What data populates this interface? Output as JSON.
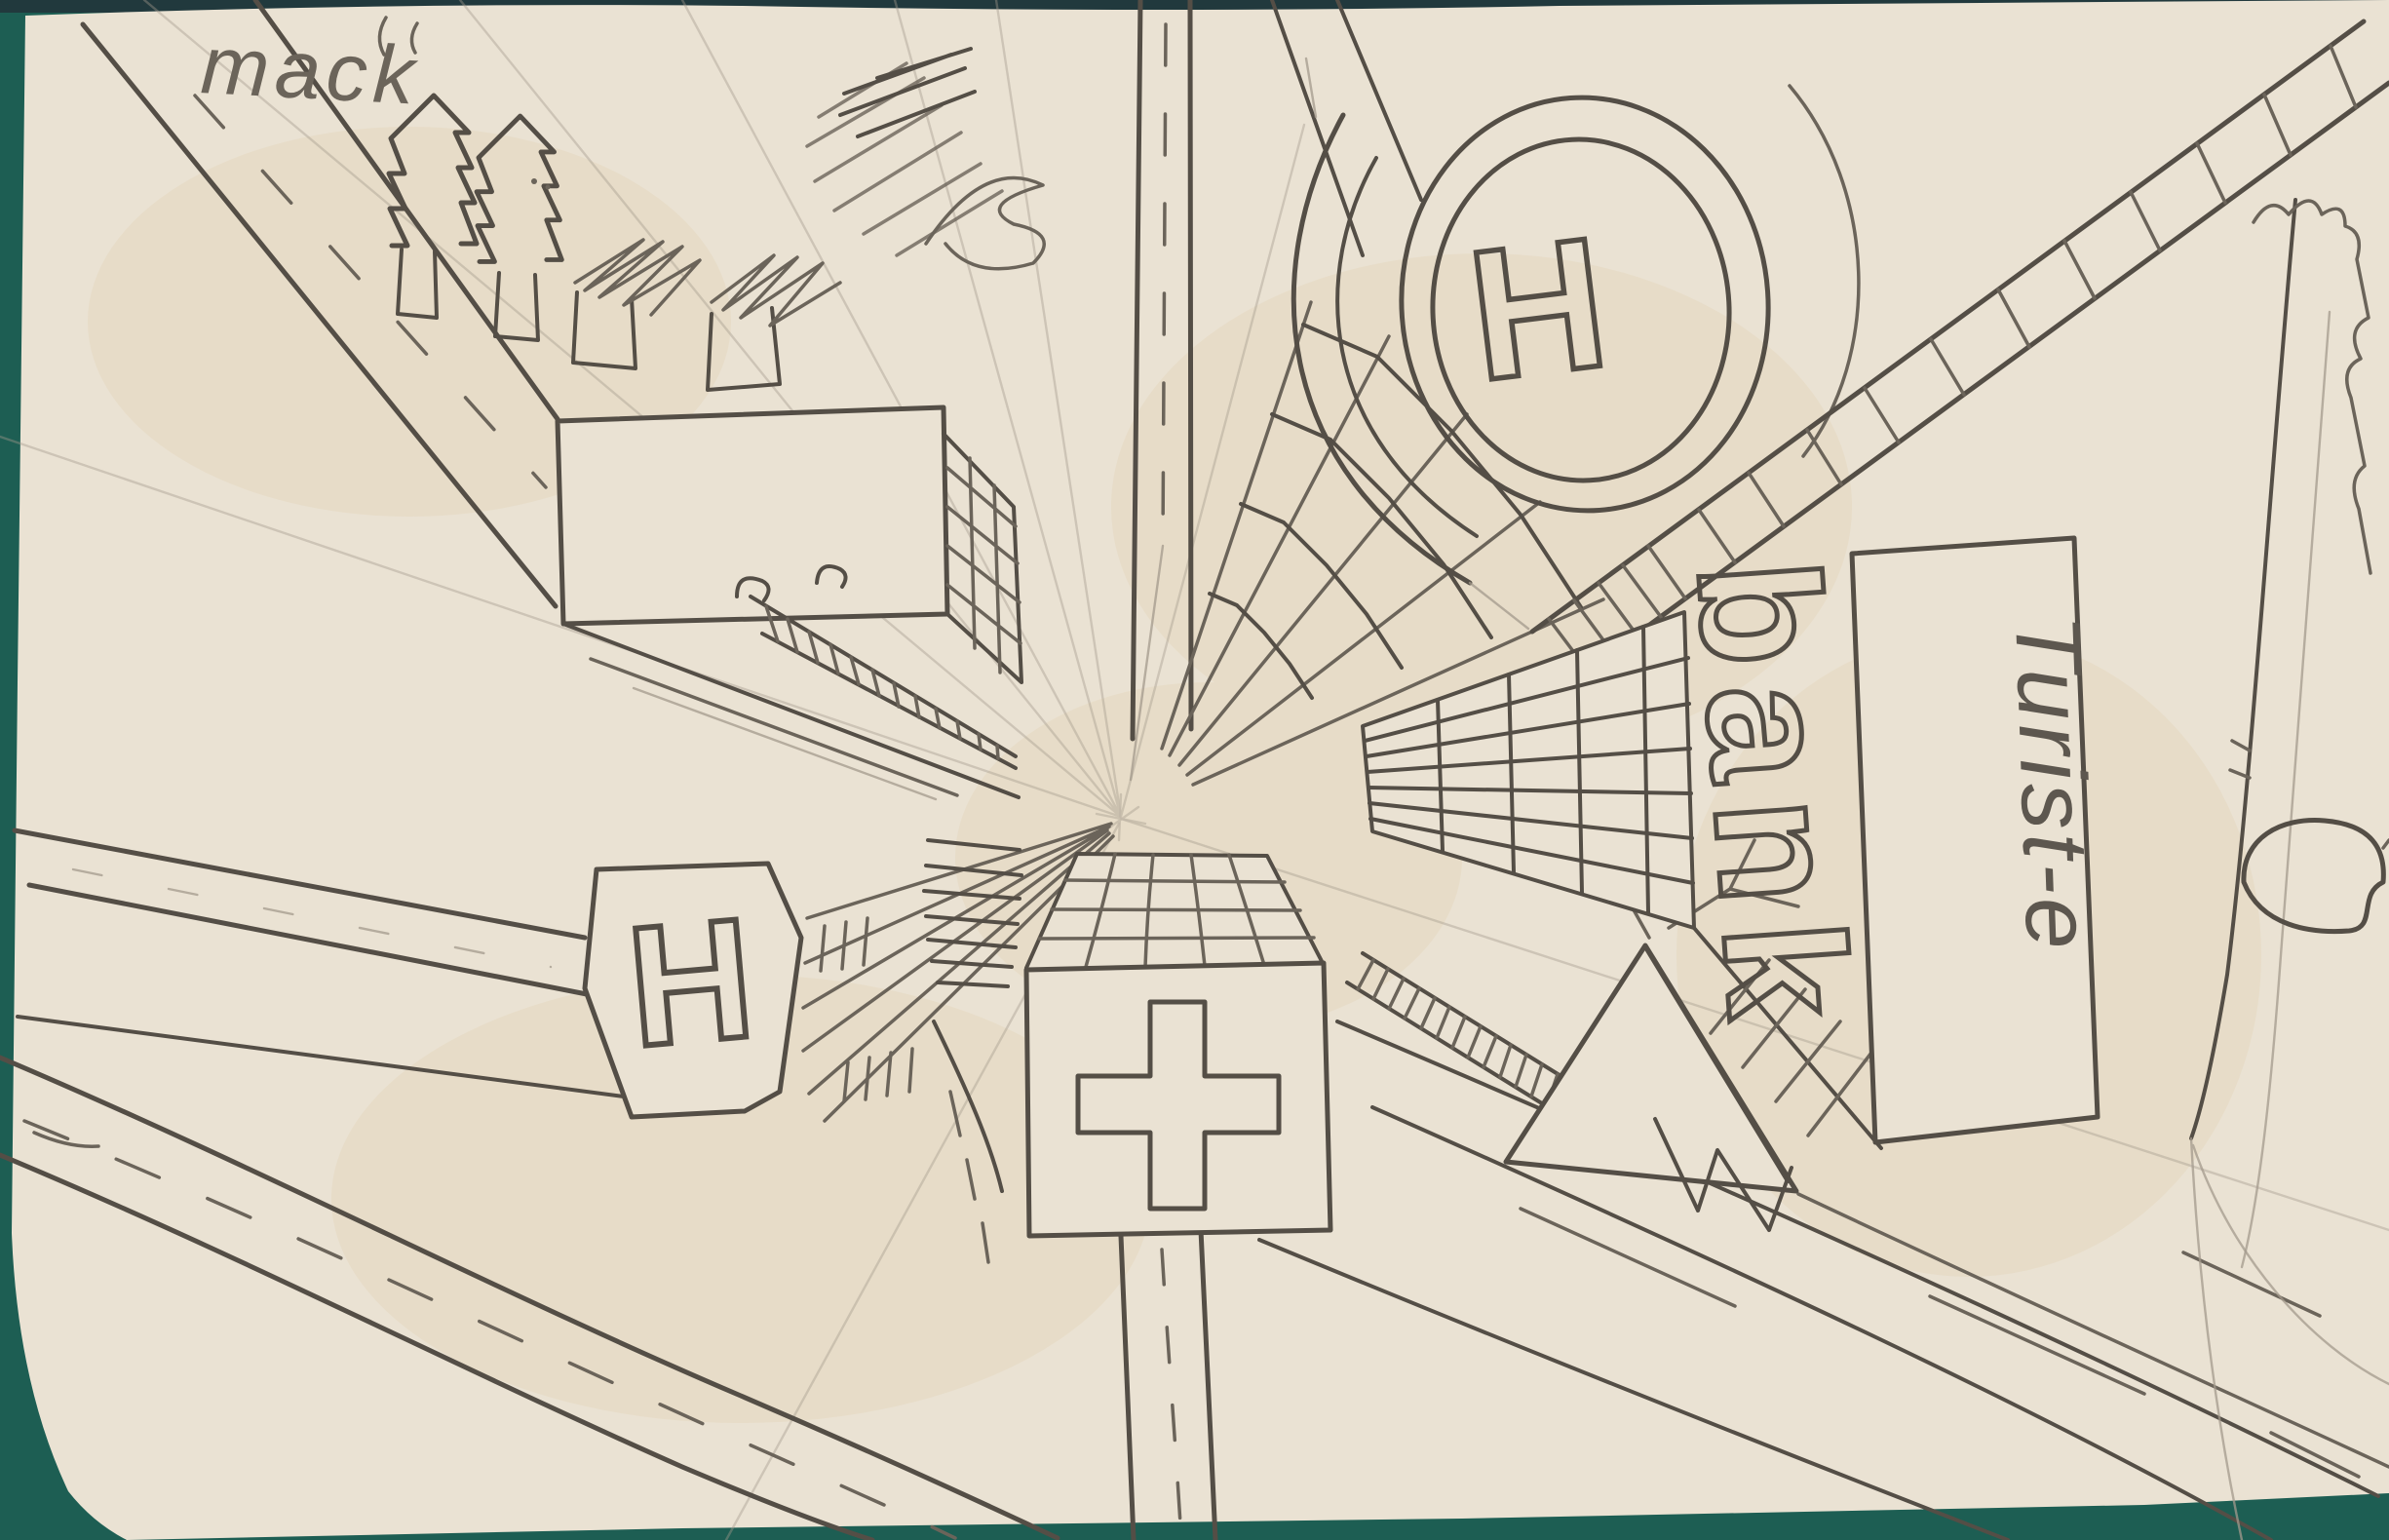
{
  "scene": {
    "title": "Hand-drawn one-point-perspective town map, pencil on paper",
    "colors": {
      "background": "#1d5e53",
      "paper": "#eae2d3",
      "pencil_dark": "#544e46",
      "pencil_mid": "#6b645a",
      "pencil_light": "#a39a8c"
    },
    "labels": {
      "signature": "mack",
      "helipad_letter": "H",
      "heliport_sign_letter": "H",
      "bank_sign": "bank",
      "tourist_sign": "Turist-e"
    }
  }
}
